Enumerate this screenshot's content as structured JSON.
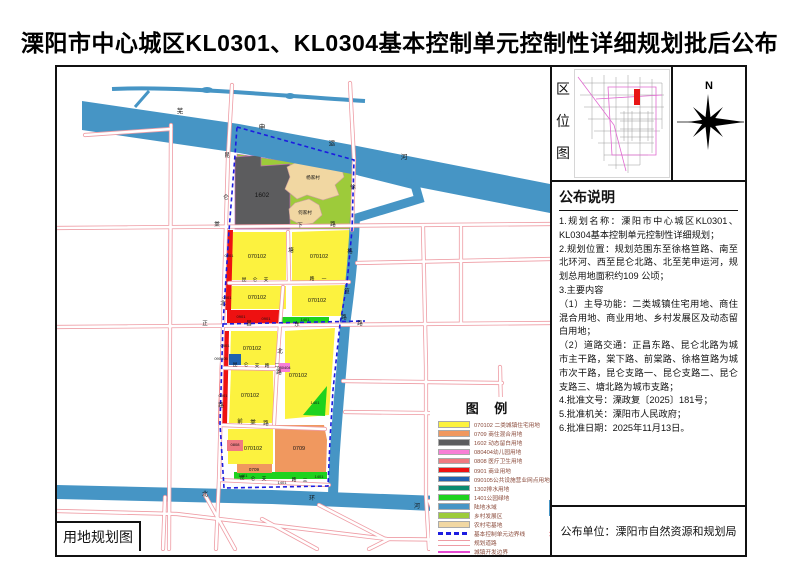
{
  "title": "溧阳市中心城区KL0301、KL0304基本控制单元控制性详细规划批后公布",
  "sheet_caption": "用地规划图",
  "location_panel": {
    "chars": [
      "区",
      "位",
      "图"
    ]
  },
  "north": {
    "label": "N"
  },
  "notice": {
    "title": "公布说明",
    "lines": [
      "1.规划名称：溧阳市中心城区KL0301、KL0304基本控制单元控制性详细规划；",
      "2.规划位置：规划范围东至徐格笪路、南至北环河、西至昆仑北路、北至芜申运河，规划总用地面积约109 公顷；",
      "3.主要内容",
      "（1）主导功能：二类城镇住宅用地、商住混合用地、商业用地、乡村发展区及动态留白用地；",
      "（2）道路交通：正昌东路、昆仑北路为城市主干路，棠下路、前棠路、徐格笪路为城市次干路，昆仑支路一、昆仑支路二、昆仑支路三、塘北路为城市支路；",
      "4.批准文号：溧政复〔2025〕181号；",
      "5.批准机关：溧阳市人民政府；",
      "6.批准日期：2025年11月13日。"
    ]
  },
  "publisher_line": "公布单位：溧阳市自然资源和规划局",
  "legend": {
    "title": "图 例",
    "items": [
      {
        "type": "fill",
        "color": "#FCF23F",
        "label": "070102 二类城镇住宅用地"
      },
      {
        "type": "fill",
        "color": "#F0985F",
        "label": "0709 商住混合用地"
      },
      {
        "type": "fill",
        "color": "#5C5C5E",
        "label": "1602 动态留白用地"
      },
      {
        "type": "fill",
        "color": "#F77FD6",
        "label": "080404幼儿园用地"
      },
      {
        "type": "fill",
        "color": "#EF7B82",
        "label": "0808 医疗卫生用地"
      },
      {
        "type": "fill",
        "color": "#EE1111",
        "label": "0901 商业用地"
      },
      {
        "type": "fill",
        "color": "#2062B0",
        "label": "090105公共设施营业网点用地"
      },
      {
        "type": "fill",
        "color": "#0A8A70",
        "label": "1302排水用地"
      },
      {
        "type": "fill",
        "color": "#1ED21E",
        "label": "1401公园绿地"
      },
      {
        "type": "fill",
        "color": "#4695C5",
        "label": "陆地水域"
      },
      {
        "type": "fill",
        "color": "#9DCB3A",
        "label": "乡村发展区"
      },
      {
        "type": "fill",
        "color": "#F1D7A2",
        "label": "农村宅基地"
      },
      {
        "type": "dash",
        "color": "#1C1CE0",
        "label": "基本控制单元边界线"
      },
      {
        "type": "road",
        "color": "#EE9CA4",
        "label": "规划道路"
      },
      {
        "type": "line",
        "color": "#E649D1",
        "label": "城镇开发边界"
      }
    ]
  },
  "colors": {
    "res": "#FCF23F",
    "mix": "#F0985F",
    "blank": "#5C5C5E",
    "kind": "#F77FD6",
    "med": "#EF7B82",
    "biz": "#EE1111",
    "pubf": "#2062B0",
    "drain": "#0A8A70",
    "park": "#1ED21E",
    "water": "#4695C5",
    "rural": "#9DCB3A",
    "home": "#F1D7A2",
    "bound": "#1C1CE0",
    "road-edge": "#EE9CA4",
    "devline": "#E649D1"
  },
  "map_labels": [
    {
      "t": "芜",
      "x": 123,
      "y": 46,
      "s": 6.5
    },
    {
      "t": "申",
      "x": 205,
      "y": 62,
      "s": 6.5
    },
    {
      "t": "运",
      "x": 275,
      "y": 78,
      "s": 6.5
    },
    {
      "t": "河",
      "x": 347,
      "y": 92,
      "s": 6.5
    },
    {
      "t": "北",
      "x": 148,
      "y": 429,
      "s": 6
    },
    {
      "t": "环",
      "x": 255,
      "y": 433,
      "s": 6
    },
    {
      "t": "河",
      "x": 360,
      "y": 441,
      "s": 6
    },
    {
      "t": "昆",
      "x": 170,
      "y": 90,
      "s": 5.5
    },
    {
      "t": "仑",
      "x": 169,
      "y": 132,
      "s": 5.5
    },
    {
      "t": "北",
      "x": 166,
      "y": 238,
      "s": 5.5
    },
    {
      "t": "路",
      "x": 164,
      "y": 340,
      "s": 5.5
    },
    {
      "t": "徐",
      "x": 296,
      "y": 122,
      "s": 5.5
    },
    {
      "t": "格",
      "x": 293,
      "y": 186,
      "s": 5.5
    },
    {
      "t": "笪",
      "x": 290,
      "y": 226,
      "s": 5.5
    },
    {
      "t": "路",
      "x": 287,
      "y": 252,
      "s": 5.5
    },
    {
      "t": "棠",
      "x": 160,
      "y": 159,
      "s": 5.5
    },
    {
      "t": "下",
      "x": 243,
      "y": 160,
      "s": 5.5
    },
    {
      "t": "路",
      "x": 276,
      "y": 159,
      "s": 5.5
    },
    {
      "t": "正",
      "x": 148,
      "y": 258,
      "s": 5.5
    },
    {
      "t": "昌",
      "x": 192,
      "y": 258,
      "s": 5.5
    },
    {
      "t": "东",
      "x": 240,
      "y": 259,
      "s": 5.5
    },
    {
      "t": "路",
      "x": 303,
      "y": 258,
      "s": 5.5
    },
    {
      "t": "昆",
      "x": 187,
      "y": 214,
      "s": 4.8
    },
    {
      "t": "仑",
      "x": 198,
      "y": 214,
      "s": 4.8
    },
    {
      "t": "支",
      "x": 209,
      "y": 214,
      "s": 4.8
    },
    {
      "t": "路",
      "x": 255,
      "y": 213,
      "s": 4.8
    },
    {
      "t": "一",
      "x": 267,
      "y": 213,
      "s": 4.8
    },
    {
      "t": "昆",
      "x": 178,
      "y": 299,
      "s": 4.8
    },
    {
      "t": "仑",
      "x": 189,
      "y": 299,
      "s": 4.8
    },
    {
      "t": "支",
      "x": 200,
      "y": 300,
      "s": 4.8
    },
    {
      "t": "路",
      "x": 210,
      "y": 300,
      "s": 4.8
    },
    {
      "t": "二",
      "x": 220,
      "y": 300,
      "s": 4.8
    },
    {
      "t": "昆",
      "x": 185,
      "y": 412,
      "s": 4.8
    },
    {
      "t": "仑",
      "x": 196,
      "y": 413,
      "s": 4.8
    },
    {
      "t": "支",
      "x": 207,
      "y": 413,
      "s": 4.8
    },
    {
      "t": "路",
      "x": 237,
      "y": 414,
      "s": 4.8
    },
    {
      "t": "三",
      "x": 248,
      "y": 415,
      "s": 4.8
    },
    {
      "t": "塘",
      "x": 234,
      "y": 185,
      "s": 5.5
    },
    {
      "t": "北",
      "x": 223,
      "y": 286,
      "s": 5.5
    },
    {
      "t": "路",
      "x": 222,
      "y": 307,
      "s": 5.5
    },
    {
      "t": "前",
      "x": 183,
      "y": 356,
      "s": 5.5
    },
    {
      "t": "棠",
      "x": 196,
      "y": 357,
      "s": 5.5
    },
    {
      "t": "路",
      "x": 209,
      "y": 358,
      "s": 5.5
    },
    {
      "t": "1602",
      "x": 205,
      "y": 130,
      "s": 6.5
    },
    {
      "t": "杨家村",
      "x": 256,
      "y": 112,
      "s": 4.6,
      "c": "#6b5537"
    },
    {
      "t": "何家村",
      "x": 248,
      "y": 147,
      "s": 4.6,
      "c": "#6b5537"
    },
    {
      "t": "070102",
      "x": 200,
      "y": 191,
      "s": 5.5
    },
    {
      "t": "070102",
      "x": 262,
      "y": 191,
      "s": 5.5
    },
    {
      "t": "070102",
      "x": 200,
      "y": 232,
      "s": 5.5
    },
    {
      "t": "070102",
      "x": 260,
      "y": 235,
      "s": 5.5
    },
    {
      "t": "070102",
      "x": 195,
      "y": 283,
      "s": 5.5
    },
    {
      "t": "070102",
      "x": 241,
      "y": 310,
      "s": 5.5
    },
    {
      "t": "070102",
      "x": 193,
      "y": 330,
      "s": 5.5
    },
    {
      "t": "070102",
      "x": 196,
      "y": 383,
      "s": 5.5
    },
    {
      "t": "0901",
      "x": 172,
      "y": 190,
      "s": 4
    },
    {
      "t": "0901",
      "x": 170,
      "y": 232,
      "s": 4
    },
    {
      "t": "0901",
      "x": 184,
      "y": 251,
      "s": 4
    },
    {
      "t": "0901",
      "x": 209,
      "y": 253,
      "s": 4
    },
    {
      "t": "0901",
      "x": 168,
      "y": 280,
      "s": 4
    },
    {
      "t": "0901",
      "x": 166,
      "y": 330,
      "s": 4
    },
    {
      "t": "1401",
      "x": 248,
      "y": 254,
      "s": 4
    },
    {
      "t": "1401",
      "x": 258,
      "y": 337,
      "s": 4
    },
    {
      "t": "1401",
      "x": 186,
      "y": 410,
      "s": 4
    },
    {
      "t": "1401",
      "x": 262,
      "y": 411,
      "s": 4
    },
    {
      "t": "1401",
      "x": 225,
      "y": 417,
      "s": 4
    },
    {
      "t": "090105",
      "x": 164,
      "y": 293,
      "s": 4
    },
    {
      "t": "080404",
      "x": 227,
      "y": 302,
      "s": 4
    },
    {
      "t": "0808",
      "x": 178,
      "y": 379,
      "s": 4
    },
    {
      "t": "0709",
      "x": 242,
      "y": 383,
      "s": 5.5
    },
    {
      "t": "0709",
      "x": 197,
      "y": 404,
      "s": 4.6
    }
  ]
}
